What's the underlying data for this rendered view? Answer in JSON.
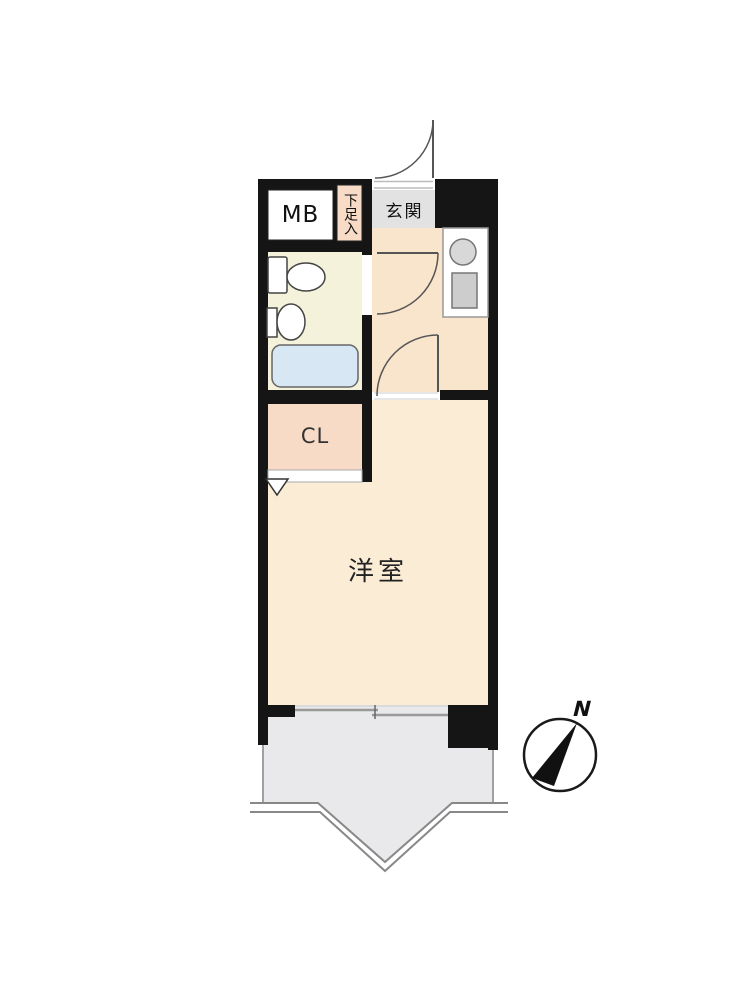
{
  "plan": {
    "labels": {
      "meter_box": "MB",
      "shoe_cabinet": "下足入",
      "entrance": "玄関",
      "closet": "CL",
      "western_room": "洋室",
      "compass_north": "N"
    },
    "colors": {
      "wall": "#151515",
      "western_room": "#FBEDD5",
      "kitchen_hall": "#F9E4CC",
      "closet": "#F7DBC6",
      "shoe_cabinet": "#F7DBC6",
      "bathroom": "#F5F2DC",
      "bathtub": "#D7E7F4",
      "entrance_floor": "#E2E2E2",
      "balcony": "#E9E9EB",
      "counter": "#FFFFFF",
      "sink": "#CDCDCD",
      "meter_box": "#FFFFFF",
      "compass_needle": "#111111"
    }
  }
}
